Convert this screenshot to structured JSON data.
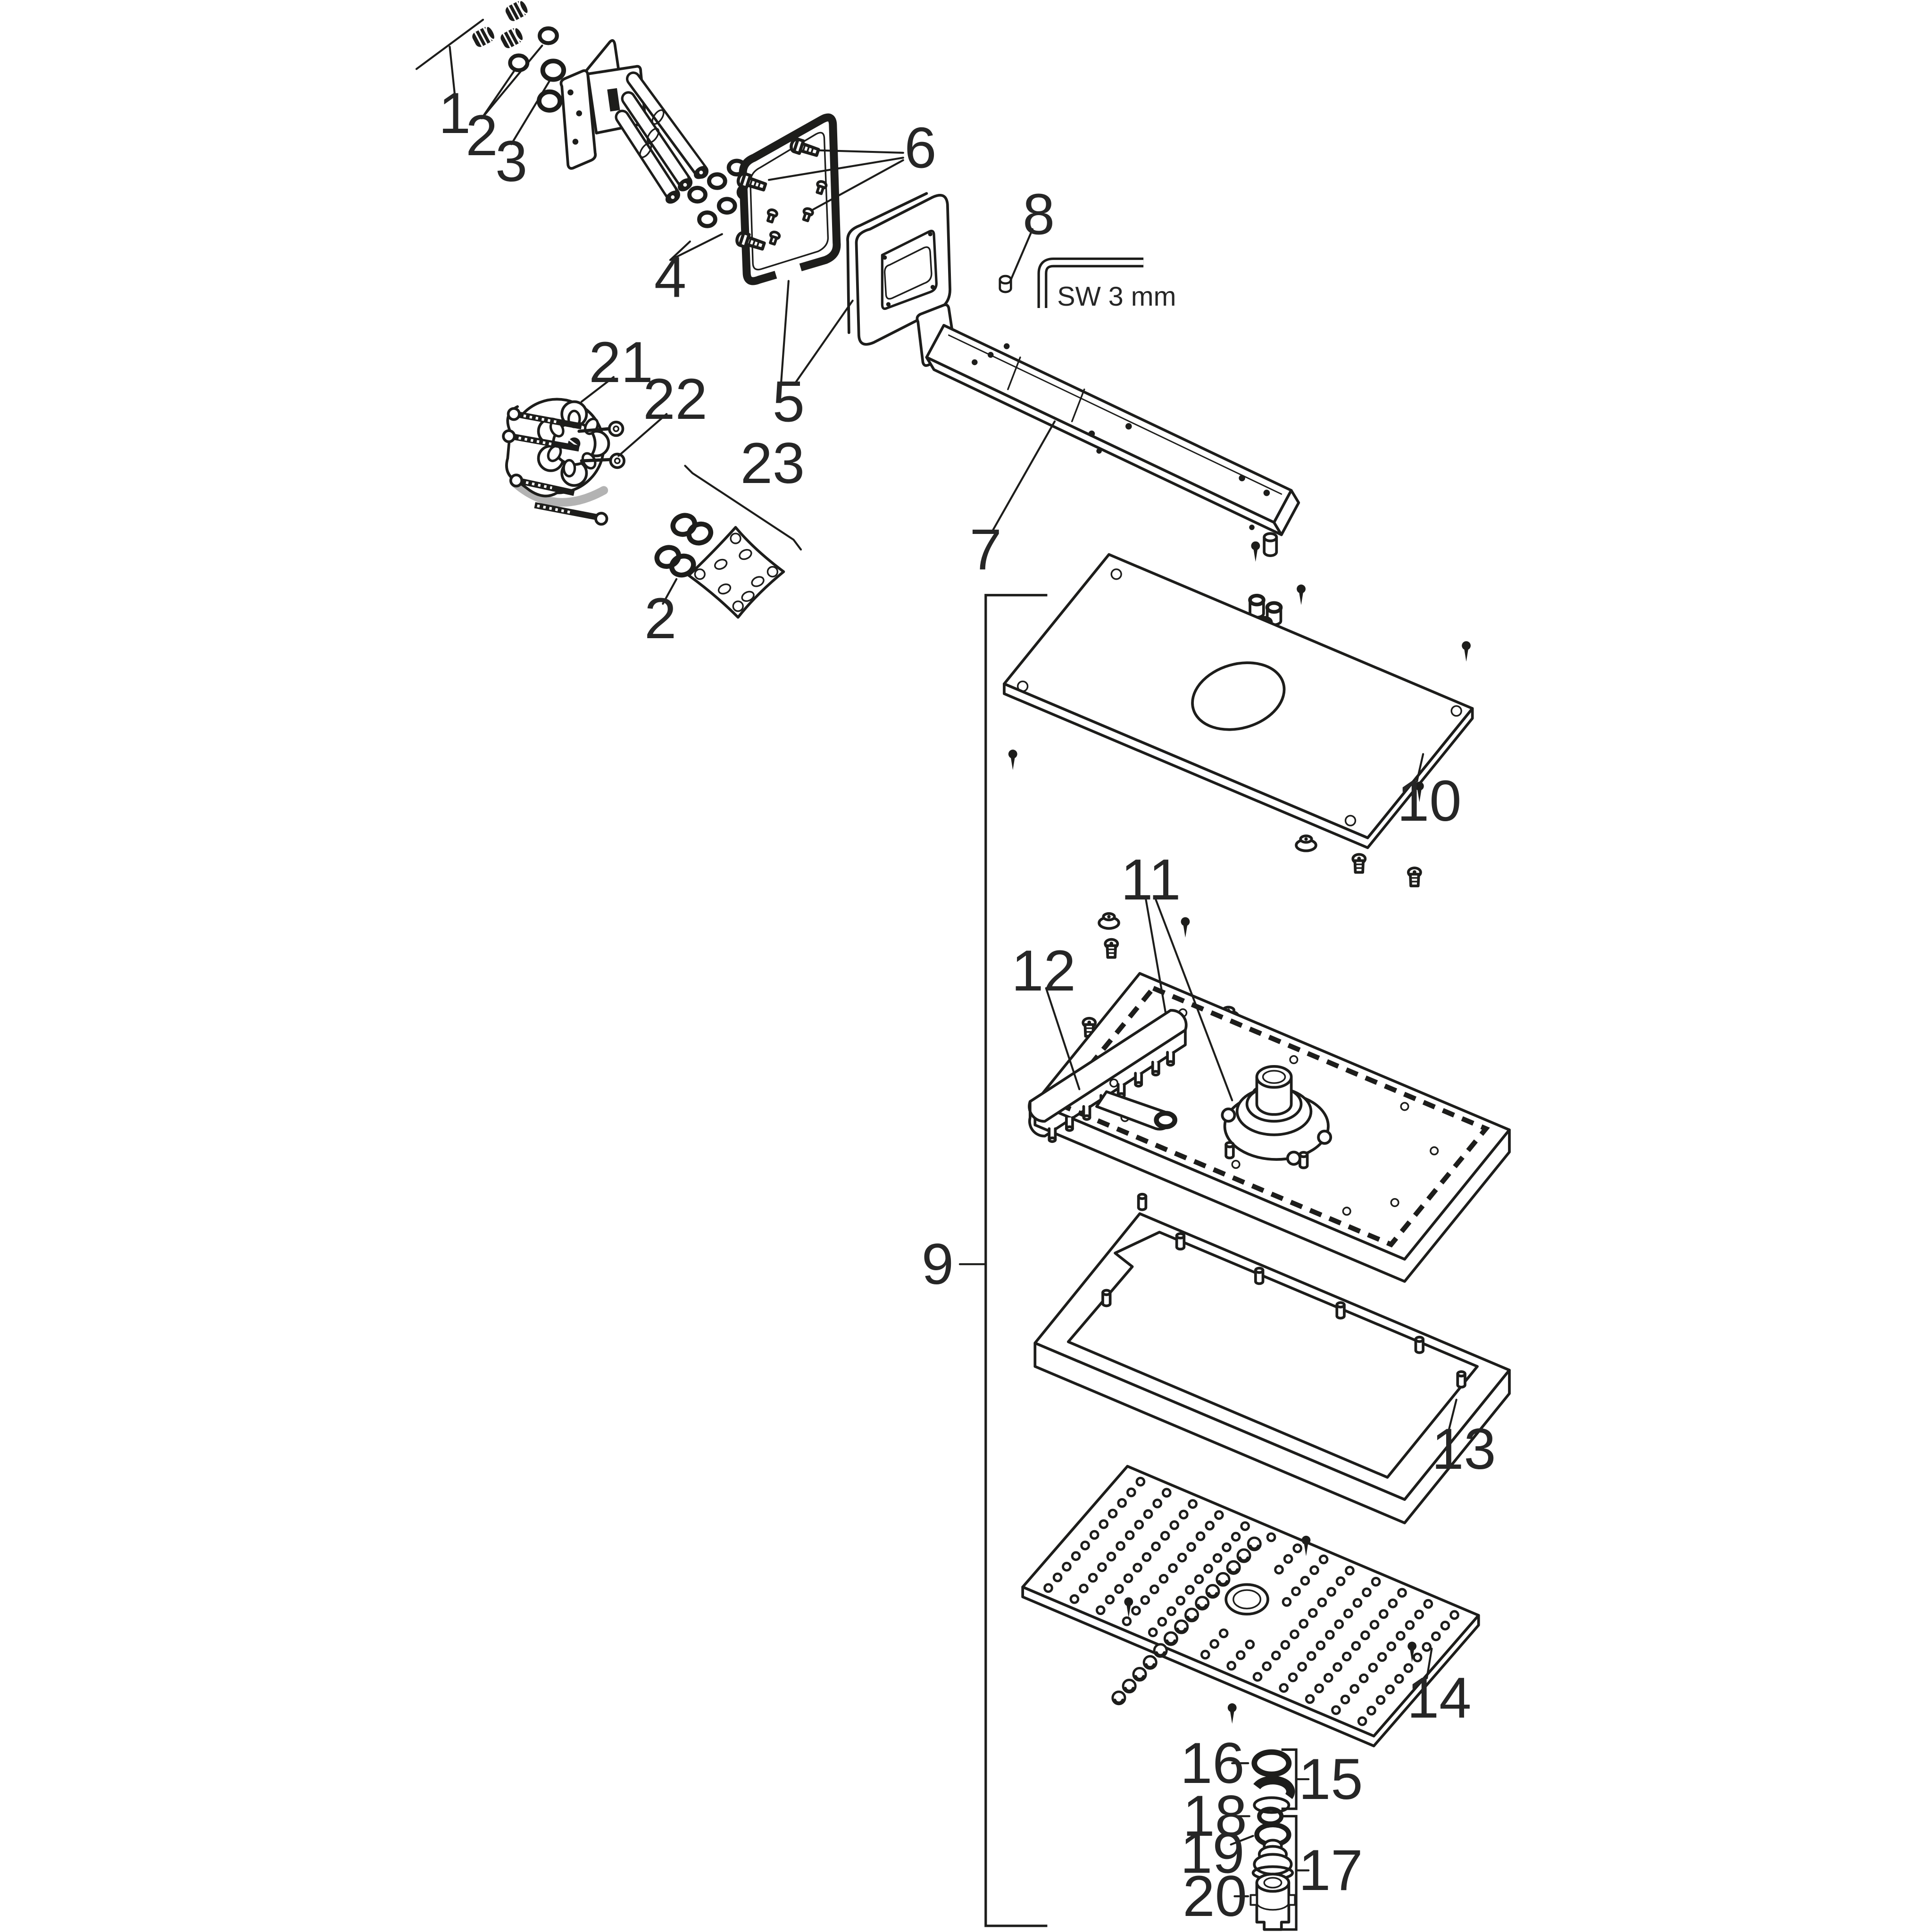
{
  "page": {
    "background": "#ffffff",
    "line_color": "#1d1d1b",
    "accent_gray": "#b3b3b3",
    "label_color": "#262626"
  },
  "callouts": {
    "c1": "1",
    "c2": "2",
    "c3": "3",
    "c4": "4",
    "c5": "5",
    "c6": "6",
    "c7": "7",
    "c8": "8",
    "c9": "9",
    "c10": "10",
    "c11": "11",
    "c12": "12",
    "c13": "13",
    "c14": "14",
    "c15": "15",
    "c16": "16",
    "c17": "17",
    "c18": "18",
    "c19": "19",
    "c20": "20",
    "c21": "21",
    "c22": "22",
    "c23": "23",
    "c2_dup": "2"
  },
  "annotations": {
    "tool_size": "SW 3 mm"
  }
}
